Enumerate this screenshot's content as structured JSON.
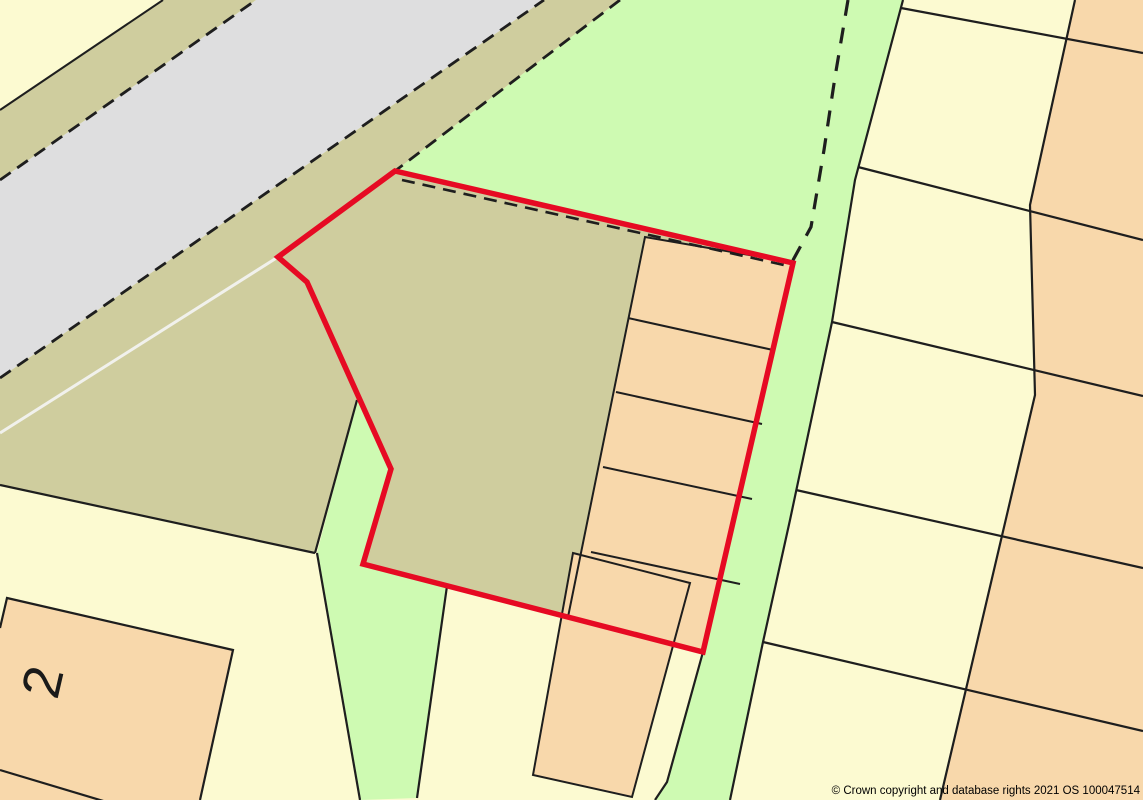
{
  "map": {
    "width": 1143,
    "height": 800,
    "labels": {
      "plot_number": "2",
      "copyright": "© Crown copyright and database rights 2021 OS 100047514"
    },
    "colors": {
      "paper_yellow": "#FCFAD1",
      "khaki": "#CFCD9E",
      "road_gray": "#DEDEDF",
      "green": "#CEFAB2",
      "orange": "#F8D8AB",
      "boundary_red": "#E60A23",
      "line_black": "#1E1E1E",
      "white_line": "#F1F1EC"
    },
    "shapes": [
      {
        "name": "road-surface",
        "points": "0,180 256,0 544,0 0,378",
        "fill": "road_gray"
      },
      {
        "name": "road-verge-northwest",
        "points": "0,110 163,0 256,0 0,180",
        "fill": "khaki"
      },
      {
        "name": "khaki-field",
        "points": "0,378 544,0 620,0 395,171 793,263 703,652 363,564 391,469 357,400 315,553 0,485",
        "fill": "khaki"
      },
      {
        "name": "green-field-and-verge",
        "points": "620,0 903,0 855,180 832,322 790,520 763,642 730,800 655,800 667,782 703,652 793,263 395,171",
        "fill": "green"
      },
      {
        "name": "green-footpath",
        "points": "357,400 391,469 363,564 447,586 417,798 360,800 317,553",
        "fill": "green"
      },
      {
        "name": "terrace-block",
        "points": "645,237 793,263 703,650 568,617",
        "fill": "orange"
      },
      {
        "name": "building-south",
        "points": "573,553 690,583 632,797 533,775",
        "fill": "orange",
        "stroke": "line_black",
        "width": 2
      },
      {
        "name": "building-no2",
        "points": "7,598 233,650 200,800 0,800 0,628",
        "fill": "orange"
      },
      {
        "name": "orange-strip-east",
        "points": "1075,0 1143,0 1143,800 940,800 1035,395 1030,205",
        "fill": "orange"
      },
      {
        "name": "plot-edge-top-left",
        "points": "0,110 163,0",
        "stroke": "line_black",
        "width": 2,
        "closed": false
      },
      {
        "name": "terrace-outline",
        "points": "568,617 645,237 790,262",
        "stroke": "line_black",
        "width": 2,
        "closed": false
      },
      {
        "name": "terrace-divider-1",
        "points": "628,318 773,350",
        "stroke": "line_black",
        "width": 2,
        "closed": false
      },
      {
        "name": "terrace-divider-2",
        "points": "616,392 762,424",
        "stroke": "line_black",
        "width": 2,
        "closed": false
      },
      {
        "name": "terrace-divider-3",
        "points": "603,467 752,499",
        "stroke": "line_black",
        "width": 2,
        "closed": false
      },
      {
        "name": "terrace-divider-4",
        "points": "591,552 740,584",
        "stroke": "line_black",
        "width": 2,
        "closed": false
      },
      {
        "name": "building-no2-outline",
        "points": "0,628 7,598 233,650 200,800",
        "stroke": "line_black",
        "width": 2.2,
        "closed": false
      },
      {
        "name": "building-no2-divider",
        "points": "0,770 110,803",
        "stroke": "line_black",
        "width": 2.2,
        "closed": false
      },
      {
        "name": "parcel-divider-1",
        "points": "901,8 1143,53",
        "stroke": "line_black",
        "width": 2.2,
        "closed": false
      },
      {
        "name": "parcel-divider-2",
        "points": "858,167 1143,240",
        "stroke": "line_black",
        "width": 2.2,
        "closed": false
      },
      {
        "name": "parcel-divider-3",
        "points": "832,322 1143,396",
        "stroke": "line_black",
        "width": 2.2,
        "closed": false
      },
      {
        "name": "parcel-divider-4",
        "points": "796,490 1143,568",
        "stroke": "line_black",
        "width": 2.2,
        "closed": false
      },
      {
        "name": "parcel-divider-5",
        "points": "763,642 1143,731",
        "stroke": "line_black",
        "width": 2.2,
        "closed": false
      },
      {
        "name": "verge-east-edge",
        "points": "903,0 855,180 832,322 790,520 763,642 730,800",
        "stroke": "line_black",
        "width": 2.2,
        "closed": false
      },
      {
        "name": "verge-west-edge-lower",
        "points": "703,652 667,782 655,800",
        "stroke": "line_black",
        "width": 2.2,
        "closed": false
      },
      {
        "name": "field-south-boundary",
        "points": "0,485 315,553",
        "stroke": "line_black",
        "width": 2.2,
        "closed": false
      },
      {
        "name": "footpath-apex-edge",
        "points": "357,400 315,553",
        "stroke": "line_black",
        "width": 2.2,
        "closed": false
      },
      {
        "name": "footpath-west-edge",
        "points": "317,553 360,800",
        "stroke": "line_black",
        "width": 2.2,
        "closed": false
      },
      {
        "name": "footpath-east-edge",
        "points": "447,586 417,798",
        "stroke": "line_black",
        "width": 2.2,
        "closed": false
      },
      {
        "name": "orange-strip-west-edge",
        "points": "1075,0 1030,205 1035,395 940,800",
        "stroke": "line_black",
        "width": 2.2,
        "closed": false
      },
      {
        "name": "road-edge-northwest-dashed",
        "points": "0,180 256,0",
        "stroke": "line_black",
        "width": 2.8,
        "dash": "13 8",
        "closed": false
      },
      {
        "name": "road-edge-southeast-dashed",
        "points": "0,378 544,0",
        "stroke": "line_black",
        "width": 2.8,
        "dash": "13 8",
        "closed": false
      },
      {
        "name": "verge-boundary-dashed",
        "points": "620,0 395,171 278,257",
        "stroke": "line_black",
        "width": 2.8,
        "dash": "13 8",
        "closed": false
      },
      {
        "name": "site-north-boundary-dashed",
        "points": "402,180 793,267",
        "stroke": "line_black",
        "width": 2.6,
        "dash": "13 8",
        "closed": false
      },
      {
        "name": "verge-center-dashed",
        "points": "848,0 835,77 824,150 811,227 792,262",
        "stroke": "line_black",
        "width": 3.2,
        "dash": "16 12",
        "closed": false
      },
      {
        "name": "track-white-line",
        "points": "0,433 278,257",
        "stroke": "white_line",
        "width": 3,
        "closed": false
      },
      {
        "name": "site-boundary",
        "points": "395,171 793,263 703,652 363,564 391,469 307,282 278,257",
        "stroke": "boundary_red",
        "width": 5.5
      }
    ]
  }
}
